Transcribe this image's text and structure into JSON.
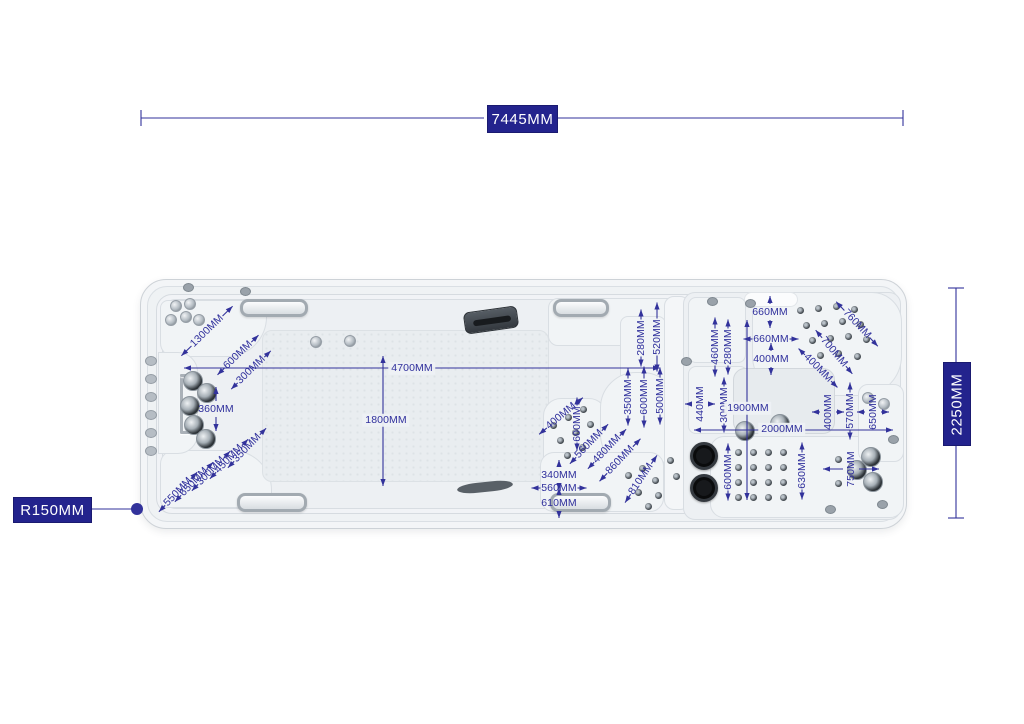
{
  "title": "Swim spa top-view dimension diagram",
  "colors": {
    "dim_blue": "#32329b",
    "box_bg": "#23238d",
    "box_text": "#ffffff"
  },
  "boxed": {
    "overall_length": "7445MM",
    "overall_width": "2250MM",
    "corner_radius": "R150MM"
  },
  "online_labels": [
    {
      "t": "4700MM",
      "x": 412,
      "y": 368
    },
    {
      "t": "1800MM",
      "x": 386,
      "y": 420
    },
    {
      "t": "1900MM",
      "x": 748,
      "y": 408
    },
    {
      "t": "2000MM",
      "x": 782,
      "y": 429
    }
  ],
  "annotations": [
    {
      "t": "1300MM",
      "x": 207,
      "y": 331,
      "rot": -44,
      "dir": -44,
      "alen": 14
    },
    {
      "t": "600MM",
      "x": 238,
      "y": 355,
      "rot": -44,
      "dir": -44,
      "alen": 10
    },
    {
      "t": "300MM",
      "x": 251,
      "y": 370,
      "rot": -44,
      "dir": -44,
      "alen": 9
    },
    {
      "t": "360MM",
      "x": 216,
      "y": 409,
      "rot": 0,
      "dir": 90,
      "alen": 14
    },
    {
      "t": "350MM",
      "x": 247,
      "y": 448,
      "rot": -46,
      "dir": -46,
      "alen": 9
    },
    {
      "t": "450MM",
      "x": 229,
      "y": 459,
      "rot": -46,
      "dir": -46,
      "alen": 9
    },
    {
      "t": "300MM",
      "x": 211,
      "y": 471,
      "rot": -46,
      "dir": -46,
      "alen": 9
    },
    {
      "t": "650MM",
      "x": 194,
      "y": 482,
      "rot": -46,
      "dir": -46,
      "alen": 9
    },
    {
      "t": "550MM",
      "x": 178,
      "y": 492,
      "rot": -46,
      "dir": -46,
      "alen": 9
    },
    {
      "t": "400MM",
      "x": 561,
      "y": 416,
      "rot": -40,
      "dir": -40,
      "alen": 10
    },
    {
      "t": "600MM",
      "x": 577,
      "y": 424,
      "rot": -90,
      "dir": 90,
      "alen": 8
    },
    {
      "t": "560MM",
      "x": 589,
      "y": 444,
      "rot": -46,
      "dir": -46,
      "alen": 9
    },
    {
      "t": "480MM",
      "x": 607,
      "y": 449,
      "rot": -46,
      "dir": -46,
      "alen": 9
    },
    {
      "t": "860MM",
      "x": 620,
      "y": 460,
      "rot": -46,
      "dir": -46,
      "alen": 11
    },
    {
      "t": "810MM",
      "x": 641,
      "y": 479,
      "rot": -56,
      "dir": -56,
      "alen": 10
    },
    {
      "t": "340MM",
      "x": 559,
      "y": 475,
      "rot": 0,
      "dir": 90,
      "alen": 7
    },
    {
      "t": "560MM",
      "x": 559,
      "y": 488,
      "rot": 0,
      "dir": 0,
      "alen": 9
    },
    {
      "t": "610MM",
      "x": 559,
      "y": 503,
      "rot": 0,
      "dir": 90,
      "alen": 7
    },
    {
      "t": "350MM",
      "x": 628,
      "y": 397,
      "rot": -90,
      "dir": 90,
      "alen": 10
    },
    {
      "t": "600MM",
      "x": 644,
      "y": 397,
      "rot": -90,
      "dir": 90,
      "alen": 12
    },
    {
      "t": "500MM",
      "x": 660,
      "y": 396,
      "rot": -90,
      "dir": 90,
      "alen": 10
    },
    {
      "t": "280MM",
      "x": 641,
      "y": 338,
      "rot": -90,
      "dir": 90,
      "alen": 10
    },
    {
      "t": "520MM",
      "x": 657,
      "y": 337,
      "rot": -90,
      "dir": 90,
      "alen": 16
    },
    {
      "t": "460MM",
      "x": 715,
      "y": 347,
      "rot": -90,
      "dir": 90,
      "alen": 11
    },
    {
      "t": "280MM",
      "x": 728,
      "y": 347,
      "rot": -90,
      "dir": 90,
      "alen": 9
    },
    {
      "t": "660MM",
      "x": 770,
      "y": 312,
      "rot": 0,
      "dir": 90,
      "alen": 8
    },
    {
      "t": "660MM",
      "x": 771,
      "y": 339,
      "rot": 0,
      "dir": 0,
      "alen": 9
    },
    {
      "t": "400MM",
      "x": 771,
      "y": 359,
      "rot": 0,
      "dir": 90,
      "alen": 8
    },
    {
      "t": "760MM",
      "x": 857,
      "y": 324,
      "rot": 47,
      "dir": 47,
      "alen": 12
    },
    {
      "t": "700MM",
      "x": 834,
      "y": 352,
      "rot": 50,
      "dir": 50,
      "alen": 10
    },
    {
      "t": "400MM",
      "x": 818,
      "y": 368,
      "rot": 45,
      "dir": 45,
      "alen": 9
    },
    {
      "t": "440MM",
      "x": 700,
      "y": 404,
      "rot": -90,
      "dir": 0,
      "alen": 7
    },
    {
      "t": "300MM",
      "x": 724,
      "y": 405,
      "rot": -90,
      "dir": 90,
      "alen": 9
    },
    {
      "t": "400MM",
      "x": 828,
      "y": 412,
      "rot": -90,
      "dir": 0,
      "alen": 8
    },
    {
      "t": "570MM",
      "x": 850,
      "y": 411,
      "rot": -90,
      "dir": 90,
      "alen": 10
    },
    {
      "t": "650MM",
      "x": 873,
      "y": 412,
      "rot": -90,
      "dir": 0,
      "alen": 8
    },
    {
      "t": "600MM",
      "x": 728,
      "y": 472,
      "rot": -90,
      "dir": 90,
      "alen": 10
    },
    {
      "t": "630MM",
      "x": 802,
      "y": 471,
      "rot": -90,
      "dir": 90,
      "alen": 10
    },
    {
      "t": "750MM",
      "x": 851,
      "y": 469,
      "rot": -90,
      "dir": 0,
      "alen": 20
    }
  ],
  "lines": [
    {
      "type": "seg",
      "x1": 141,
      "y1": 118,
      "x2": 484,
      "y2": 118
    },
    {
      "type": "seg",
      "x1": 558,
      "y1": 118,
      "x2": 903,
      "y2": 118
    },
    {
      "type": "tick",
      "x": 141,
      "y": 118,
      "o": "v"
    },
    {
      "type": "tick",
      "x": 903,
      "y": 118,
      "o": "v"
    },
    {
      "type": "seg",
      "x1": 956,
      "y1": 288,
      "x2": 956,
      "y2": 362
    },
    {
      "type": "seg",
      "x1": 956,
      "y1": 444,
      "x2": 956,
      "y2": 518
    },
    {
      "type": "tick",
      "x": 956,
      "y": 288,
      "o": "h"
    },
    {
      "type": "tick",
      "x": 956,
      "y": 518,
      "o": "h"
    },
    {
      "type": "arrline",
      "x1": 184,
      "y1": 368,
      "x2": 660,
      "y2": 368
    },
    {
      "type": "arrline",
      "x1": 383,
      "y1": 356,
      "x2": 383,
      "y2": 486
    },
    {
      "type": "arrline",
      "x1": 747,
      "y1": 320,
      "x2": 747,
      "y2": 500
    },
    {
      "type": "arrline",
      "x1": 694,
      "y1": 430,
      "x2": 893,
      "y2": 430
    },
    {
      "type": "seg",
      "x1": 90,
      "y1": 509,
      "x2": 133,
      "y2": 509
    },
    {
      "type": "dot",
      "x": 137,
      "y": 509,
      "r": 6
    }
  ],
  "features": {
    "jets_chrome_sm": [
      [
        171,
        320
      ],
      [
        186,
        317
      ],
      [
        199,
        320
      ],
      [
        176,
        306
      ],
      [
        190,
        304
      ],
      [
        316,
        342
      ],
      [
        350,
        341
      ],
      [
        868,
        398
      ],
      [
        884,
        404
      ]
    ],
    "jets_chrome_lg": [
      [
        193,
        381
      ],
      [
        207,
        393
      ],
      [
        190,
        406
      ],
      [
        194,
        425
      ],
      [
        206,
        439
      ],
      [
        745,
        431
      ],
      [
        780,
        424
      ],
      [
        871,
        457
      ],
      [
        857,
        470
      ],
      [
        873,
        482
      ]
    ],
    "jets_dark_sm": [
      [
        553,
        425
      ],
      [
        568,
        417
      ],
      [
        583,
        409
      ],
      [
        560,
        440
      ],
      [
        575,
        432
      ],
      [
        590,
        424
      ],
      [
        567,
        455
      ],
      [
        582,
        447
      ],
      [
        628,
        475
      ],
      [
        642,
        468
      ],
      [
        655,
        480
      ],
      [
        638,
        492
      ],
      [
        658,
        495
      ],
      [
        648,
        506
      ],
      [
        800,
        310
      ],
      [
        818,
        308
      ],
      [
        836,
        306
      ],
      [
        854,
        309
      ],
      [
        806,
        325
      ],
      [
        824,
        323
      ],
      [
        842,
        321
      ],
      [
        860,
        324
      ],
      [
        812,
        340
      ],
      [
        830,
        338
      ],
      [
        848,
        336
      ],
      [
        866,
        339
      ],
      [
        820,
        355
      ],
      [
        838,
        353
      ],
      [
        857,
        356
      ],
      [
        738,
        452
      ],
      [
        753,
        452
      ],
      [
        768,
        452
      ],
      [
        783,
        452
      ],
      [
        738,
        467
      ],
      [
        753,
        467
      ],
      [
        768,
        467
      ],
      [
        783,
        467
      ],
      [
        738,
        482
      ],
      [
        753,
        482
      ],
      [
        768,
        482
      ],
      [
        783,
        482
      ],
      [
        738,
        497
      ],
      [
        753,
        497
      ],
      [
        768,
        497
      ],
      [
        783,
        497
      ],
      [
        838,
        459
      ],
      [
        838,
        483
      ],
      [
        670,
        460
      ],
      [
        676,
        476
      ]
    ],
    "jets_black": [
      [
        704,
        456
      ],
      [
        704,
        488
      ]
    ],
    "wall_ovals": [
      [
        151,
        361
      ],
      [
        151,
        379
      ],
      [
        151,
        397
      ],
      [
        151,
        415
      ],
      [
        151,
        433
      ],
      [
        151,
        451
      ]
    ],
    "bolts": [
      [
        188,
        287
      ],
      [
        245,
        291
      ],
      [
        712,
        301
      ],
      [
        750,
        303
      ],
      [
        893,
        439
      ],
      [
        882,
        504
      ],
      [
        830,
        509
      ],
      [
        686,
        361
      ]
    ],
    "handles": [
      [
        240,
        299,
        62,
        12
      ],
      [
        553,
        299,
        50,
        12
      ],
      [
        237,
        493,
        64,
        13
      ],
      [
        550,
        493,
        55,
        13
      ]
    ]
  }
}
